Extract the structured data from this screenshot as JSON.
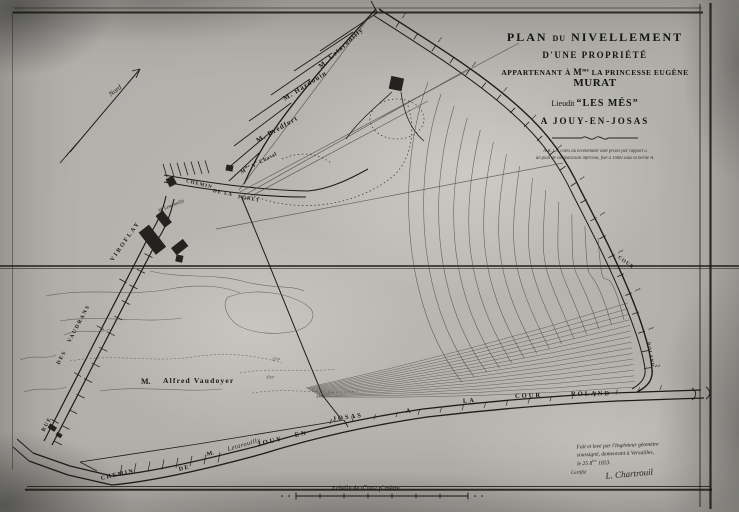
{
  "title_block": {
    "l1a": "PLAN",
    "l1b": "DU",
    "l1c": "NIVELLEMENT",
    "l2": "D'UNE PROPRIÉTÉ",
    "l3a": "APPARTENANT À",
    "l3b_m": "M",
    "l3b_sup": "me",
    "l3c": "LA PRINCESSE EUGÈNE",
    "l3d": "MURAT",
    "l4a": "Lieudit",
    "l4b": "“LES MÉS”",
    "l5": "A JOUY-EN-JOSAS",
    "note1": "N.B. Les côtes du nivellement sont prises par rapport à",
    "note2": "un plan de comparaison inférieur, fixé à 1m00 sous la borne A."
  },
  "compass": {
    "label": "Nord"
  },
  "neighbors": {
    "n1": "M. Letarouilly",
    "n2": "M. Hardouin",
    "n3": "M. Bredfort",
    "n4_m": "M",
    "n4_sup1": "me",
    "n4_v": "V",
    "n4_sup2": "e",
    "n4_name": "Chasal"
  },
  "village": {
    "owner": "M. Letarouilly",
    "road_w1": "CHEMIN",
    "road_w2": "DE LA",
    "road_w3": "FORET",
    "viroflay": "VIROFLAY"
  },
  "rue": {
    "w1": "RUE",
    "w2": "DES",
    "w3": "VAUDRANS"
  },
  "vaudoyer": {
    "prefix": "M.",
    "name": "Alfred Vaudoyer"
  },
  "bottom_road": {
    "w1": "CHEMIN",
    "w2": "DE",
    "w3": "JOUY",
    "w4": "EN",
    "w5": "JOSAS",
    "w6": "A",
    "w7": "LA",
    "w8": "COUR",
    "w9": "ROLAND",
    "owner_prefix": "M.",
    "owner_name": "Letarouilly"
  },
  "right_bend": {
    "w1": "COUR",
    "w2": "ROLAND"
  },
  "contour_labels": {
    "c1": "37m",
    "c2": "35m",
    "c3": "34m"
  },
  "scale": {
    "p1": "Echelle de 0",
    "sup1": "m",
    "p2": "002 p",
    "sup2": "r",
    "p3": " mètre"
  },
  "signature": {
    "l1": "Fait et levé par l'Ingénieur géomètre",
    "l2": "soussigné, demeurant à Versailles,",
    "l3a": "le 25 8",
    "l3sup": "bre",
    "l3b": " 1853.",
    "name": "L. Chartrouil",
    "left": "Certifié"
  },
  "colors": {
    "paper": "#b2b0ab",
    "ink": "#1f1f1d"
  }
}
